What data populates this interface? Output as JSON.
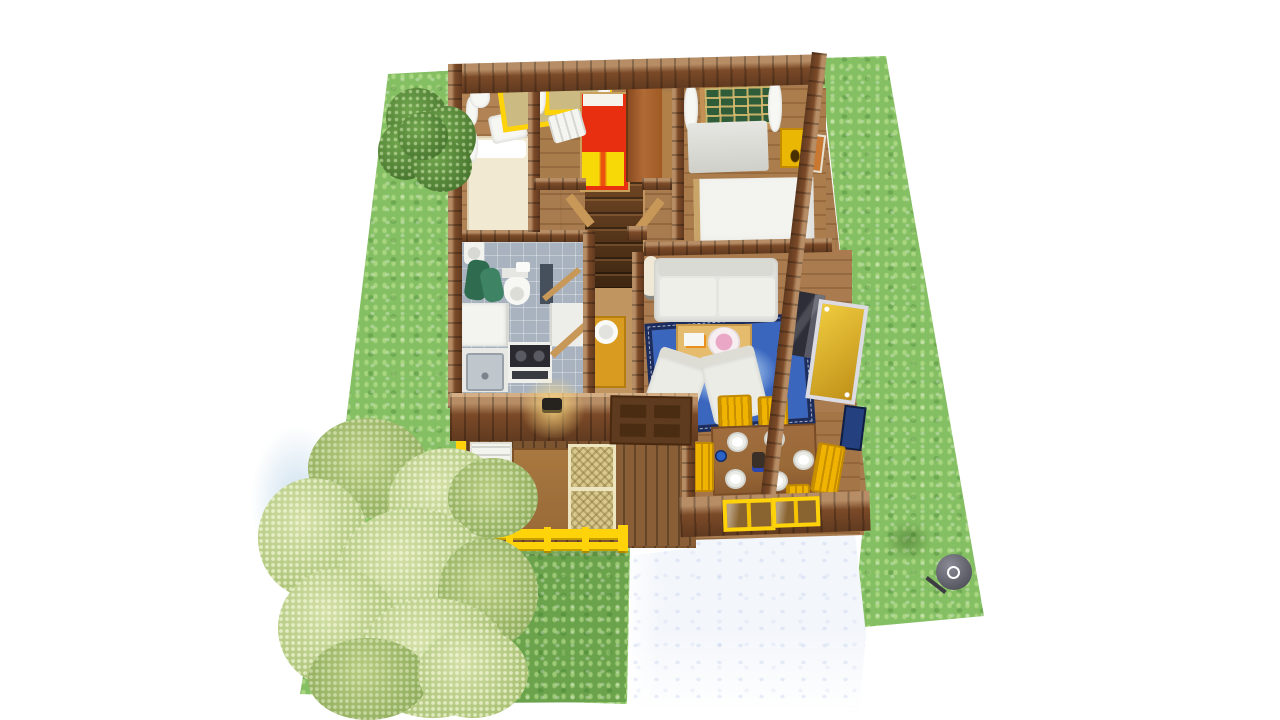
{
  "scene": {
    "type": "3d-floorplan-render",
    "description": "Top-down 3D rendering of a small single-storey house with furnished rooms, green garden lawn, two trees, white tiled patio and a round barbecue grill",
    "background": "#ffffff"
  },
  "palette": {
    "lawn": "#85BF63",
    "lawn_dark": "#6BA34C",
    "patio": "#F3F6FB",
    "wall_wood": "#7B4A28",
    "floor_wood": "#A87C4E",
    "hall_floor": "#C1955F",
    "porch_floor": "#7D5430",
    "tile_floor": "#A9B3BF",
    "accent_yellow": "#FFD30A",
    "furniture_yellow": "#EFB300",
    "rug_blue": "#3A66BE",
    "rug_border": "#1B2C5E",
    "bed_red": "#E83010",
    "bed_yellow": "#F7D908",
    "wardrobe_brown": "#B06A35",
    "sofa_gray": "#E5E5E1",
    "tv_dark": "#2E2E38",
    "green_window": "#2F5D3A",
    "towel_green": "#2E6B4F",
    "table_brown": "#9A6A38",
    "grill_gray": "#54555E",
    "tree_dark": "#4E7F33",
    "tree_light": "#C3D795"
  },
  "yard": {
    "lawn_label": "garden lawn",
    "lawn_dark_label": "shaded lawn patch",
    "patio_label": "white tiled patio",
    "trees": [
      {
        "id": "tree-small",
        "label": "dark green tree, top left"
      },
      {
        "id": "tree-large",
        "label": "light green tree, bottom left"
      }
    ],
    "grill_label": "round barbecue grill"
  },
  "house": {
    "label": "single storey house, top-down view",
    "rooms": [
      {
        "id": "bedroom-left",
        "label": "bedroom (top left)",
        "furniture": [
          "single bed with cream bedding",
          "white chair",
          "yellow window frame with white curtains",
          "wall curtains"
        ]
      },
      {
        "id": "kids-room",
        "label": "small bedroom (top middle)",
        "furniture": [
          "red and yellow bed",
          "brown wardrobe",
          "white spindle chair",
          "yellow window with curtains"
        ]
      },
      {
        "id": "bedroom-right",
        "label": "master bedroom (top right)",
        "furniture": [
          "double bed with white duvet",
          "white dresser",
          "yellow nightstand",
          "green window with curtains",
          "wall picture"
        ]
      },
      {
        "id": "bathroom",
        "label": "bathroom",
        "furniture": [
          "toilet",
          "washbasin",
          "green towels",
          "shower panel",
          "open door"
        ]
      },
      {
        "id": "kitchen",
        "label": "kitchen",
        "furniture": [
          "fridge",
          "sink counter",
          "stove with two burners",
          "tall cabinet"
        ]
      },
      {
        "id": "hallway",
        "label": "hallway with staircase",
        "furniture": [
          "winder staircase",
          "yellow washstand with basin",
          "front door",
          "wall lamp"
        ]
      },
      {
        "id": "living-room",
        "label": "living room",
        "furniture": [
          "white sofa",
          "two white armchairs",
          "coffee table with pink bowl and books",
          "blue oriental rug",
          "tv set",
          "gold framed mirror",
          "floor lamp",
          "blue wall picture"
        ]
      },
      {
        "id": "dining-room",
        "label": "dining room",
        "furniture": [
          "brown dining table",
          "six white plates",
          "blue dish",
          "yellow chairs",
          "yellow benches",
          "two yellow framed windows"
        ]
      },
      {
        "id": "porch",
        "label": "covered porch",
        "furniture": [
          "white slatted lounger",
          "wooden table",
          "two wicker chairs",
          "yellow railing"
        ]
      }
    ]
  }
}
